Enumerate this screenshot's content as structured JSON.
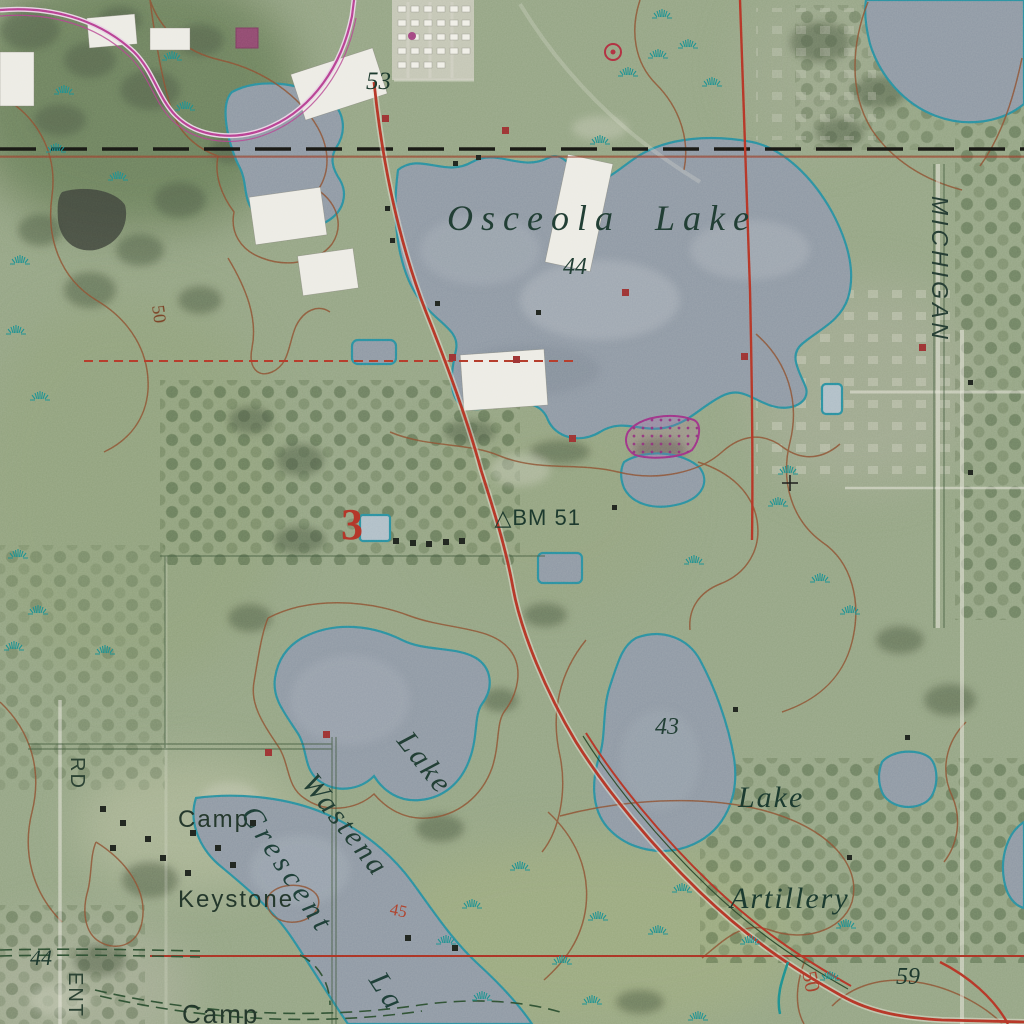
{
  "map": {
    "kind": "orthophoto topographic map",
    "labels": {
      "osceola_lake": "Osceola  Lake",
      "osceola_elev": "44",
      "spot_53": "53",
      "michigan_road": "MICHIGAN",
      "benchmark_symbol": "△",
      "benchmark_text": "BM 51",
      "section_3": "3",
      "wastena_line1": "Lake",
      "wastena_line2": "Wastena",
      "lake43_elev": "43",
      "artillery_line1": "Lake",
      "artillery_line2": "Artillery",
      "camp_keystone_line1": "Camp",
      "camp_keystone_line2": "Keystone",
      "road_rd": "RD",
      "crescent": "Crescent",
      "crescent_cont": "La",
      "contour_45": "45",
      "spot_44_sw": "44",
      "road_ent": "ENT",
      "camp_partial": "Camp",
      "contour_50_se": "50",
      "spot_59": "59",
      "contour_50_w": "50"
    },
    "colors": {
      "water_fill": "#8d97a3",
      "water_outline": "#2c8d9e",
      "contour_brown": "#8a5134",
      "road_red": "#b23527",
      "road_magenta": "#b5408f",
      "boundary_black": "#191915",
      "marsh_teal": "#1e8c8c",
      "revision_purple": "#9c3585",
      "label_green": "#1e3c31",
      "label_red": "#b5372a"
    },
    "symbols": [
      "water-tank",
      "benchmark",
      "marsh",
      "trailer-park",
      "section-corner-cross",
      "gravel-pit"
    ]
  }
}
